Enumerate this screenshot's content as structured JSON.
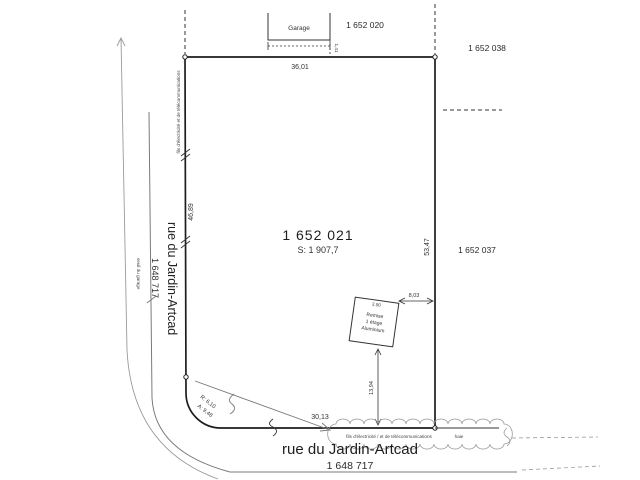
{
  "plan": {
    "main_lot": {
      "number": "1 652 021",
      "area": "S: 1 907,7"
    },
    "adjacent_lots": {
      "top": "1 652 020",
      "top_right": "1 652 038",
      "right": "1 652 037"
    },
    "streets": {
      "left": {
        "name": "rue du Jardin-Artcad",
        "number": "1 648 717"
      },
      "bottom": {
        "name": "rue du Jardin-Artcad",
        "number": "1 648 717"
      }
    },
    "buildings": {
      "garage": {
        "label": "Garage",
        "offset": "1,41"
      },
      "shed": {
        "line1": "Remise",
        "line2": "1 étage",
        "line3": "Aluminium",
        "width": "3,90"
      }
    },
    "dimensions": {
      "top": "36,01",
      "left": "46,89",
      "right": "53,47",
      "bottom": "30,13",
      "shed_to_right": "8,03",
      "shed_to_bottom": "13,94"
    },
    "curve": {
      "radius": "R: 6,10",
      "arc": "A: 9,48"
    },
    "annotations": {
      "utilities_bottom": "fils d'électricité / et de télécommunications",
      "utilities_left": "fils d'électricité et de télécommunications",
      "hedge": "haie",
      "far_left": "seuil du garage"
    }
  }
}
